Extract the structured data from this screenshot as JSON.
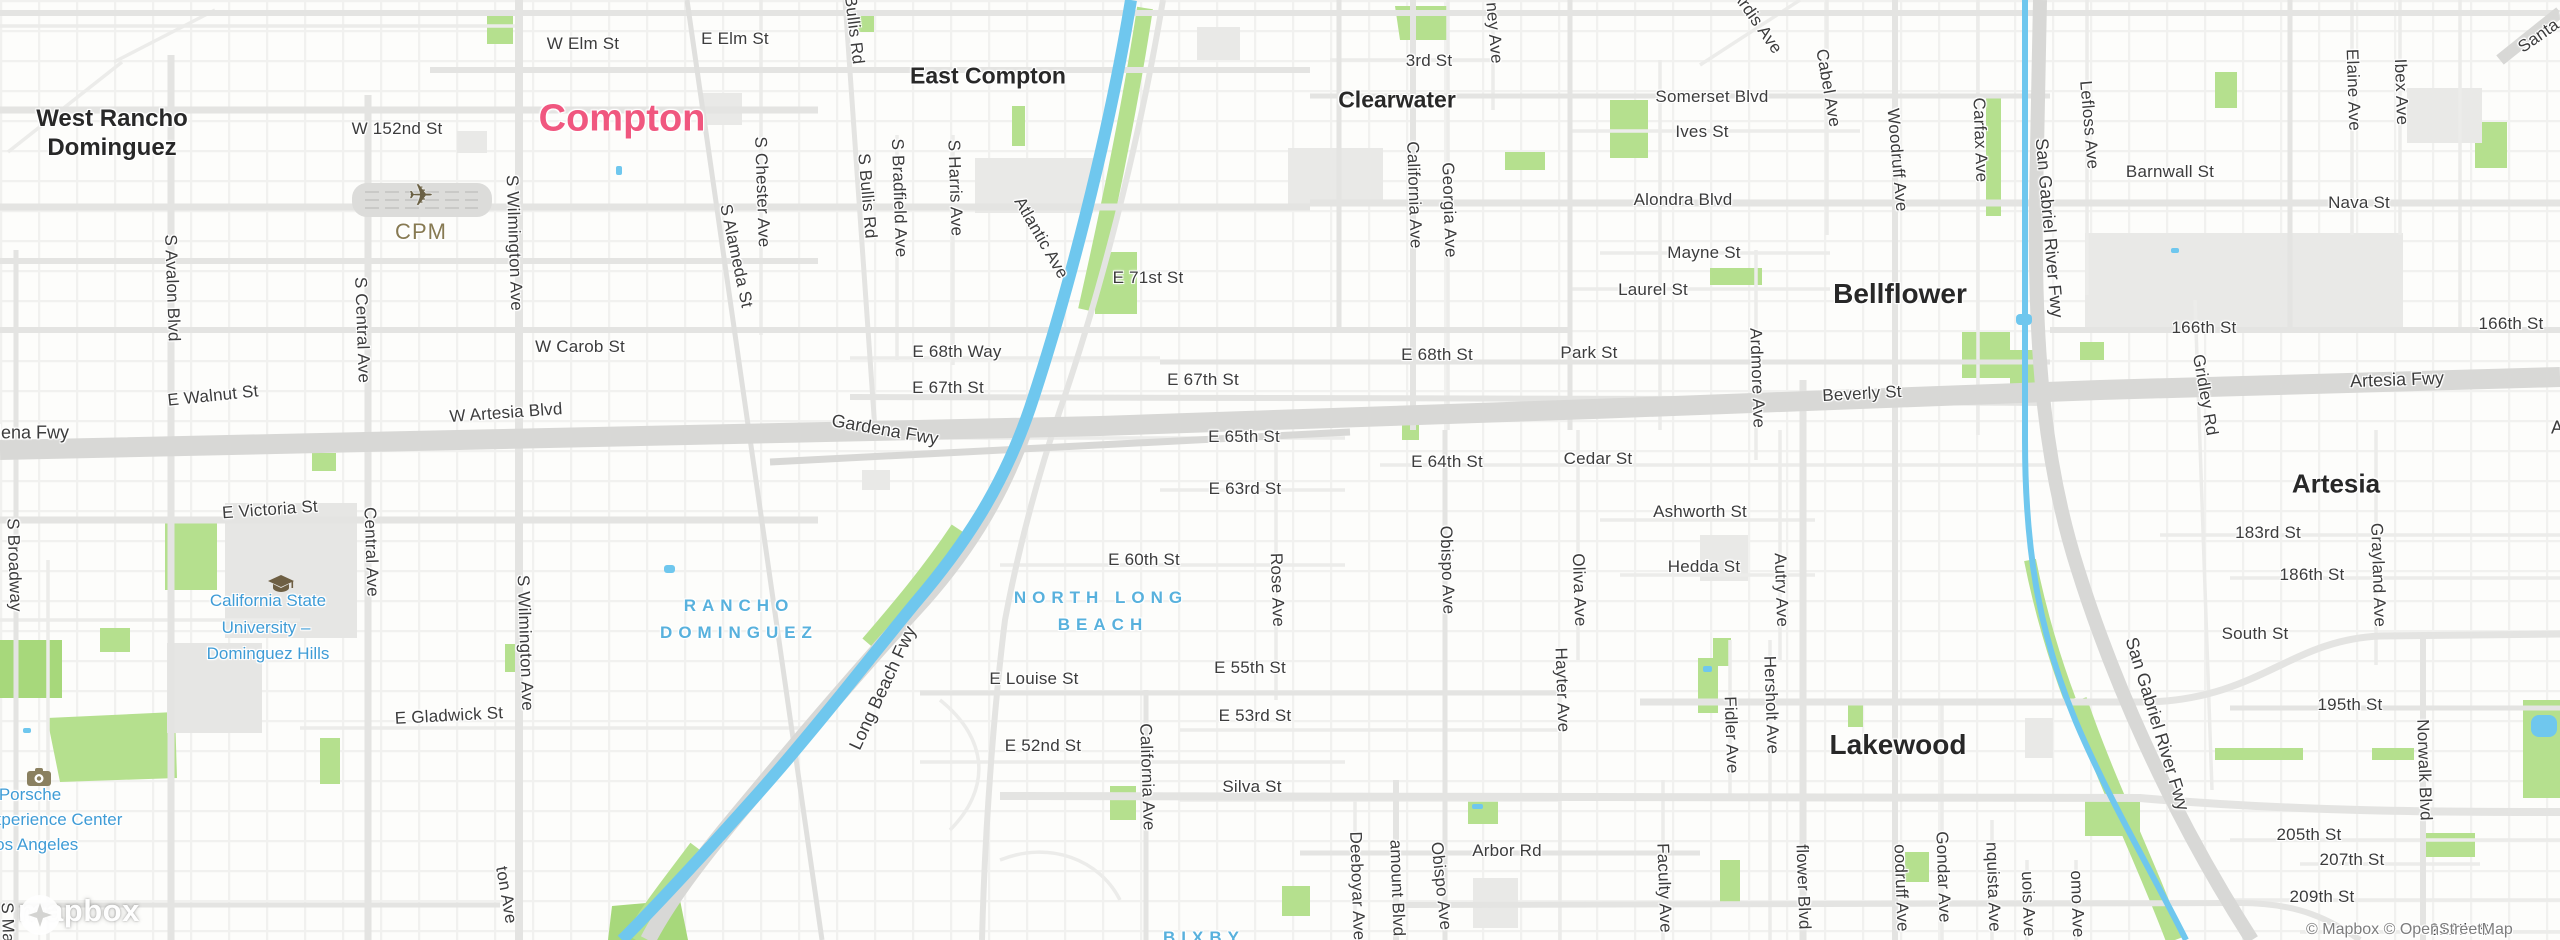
{
  "map": {
    "attribution": "© Mapbox © OpenStreetMap",
    "logo_text": "mapbox",
    "colors": {
      "city": "#f0577f",
      "town": "#282828",
      "district": "#58b1dd",
      "poi": "#3f9cd6",
      "street": "#3c3c3c",
      "airport": "#877a52",
      "water": "#6fc7ee",
      "park": "#b5e08e",
      "park_dark": "#a7d87b",
      "road": "#e4e4e2",
      "road_minor": "#ececea",
      "freeway": "#d8d8d6",
      "building": "#e9e9e7"
    },
    "labels": {
      "cities": [
        {
          "t": "Compton",
          "x": 622,
          "y": 119
        }
      ],
      "towns": [
        {
          "t": "West Rancho",
          "x": 112,
          "y": 119,
          "s": 24
        },
        {
          "t": "Dominguez",
          "x": 112,
          "y": 148,
          "s": 24
        },
        {
          "t": "East Compton",
          "x": 988,
          "y": 76,
          "s": 23
        },
        {
          "t": "Clearwater",
          "x": 1397,
          "y": 100,
          "s": 23
        },
        {
          "t": "Bellflower",
          "x": 1900,
          "y": 294,
          "s": 28
        },
        {
          "t": "Artesia",
          "x": 2336,
          "y": 484,
          "s": 26
        },
        {
          "t": "Lakewood",
          "x": 1898,
          "y": 745,
          "s": 28
        }
      ],
      "districts": [
        {
          "t": "NORTH LONG",
          "x": 1101,
          "y": 598
        },
        {
          "t": "BEACH",
          "x": 1103,
          "y": 625
        },
        {
          "t": "RANCHO",
          "x": 739,
          "y": 606
        },
        {
          "t": "DOMINGUEZ",
          "x": 739,
          "y": 633
        },
        {
          "t": "BIXBY",
          "x": 1204,
          "y": 938
        }
      ],
      "pois": [
        {
          "t": "California State",
          "x": 268,
          "y": 601
        },
        {
          "t": "University –",
          "x": 266,
          "y": 628
        },
        {
          "t": "Dominguez Hills",
          "x": 268,
          "y": 654
        },
        {
          "t": "Porsche",
          "x": 30,
          "y": 795
        },
        {
          "t": "Experience Center",
          "x": 52,
          "y": 820
        },
        {
          "t": "Los Angeles",
          "x": 32,
          "y": 845
        }
      ],
      "airport": {
        "t": "CPM",
        "x": 421,
        "y": 232
      },
      "streets": [
        {
          "t": "W Elm St",
          "x": 583,
          "y": 44
        },
        {
          "t": "E Elm St",
          "x": 735,
          "y": 39
        },
        {
          "t": "Bullis Rd",
          "x": 854,
          "y": 30,
          "r": 83
        },
        {
          "t": "W 152nd St",
          "x": 397,
          "y": 129
        },
        {
          "t": "S Avalon Blvd",
          "x": 172,
          "y": 288,
          "r": 88
        },
        {
          "t": "S Central Ave",
          "x": 362,
          "y": 330,
          "r": 88
        },
        {
          "t": "Central Ave",
          "x": 371,
          "y": 552,
          "r": 88
        },
        {
          "t": "S Wilmington Ave",
          "x": 514,
          "y": 243,
          "r": 88
        },
        {
          "t": "S Wilmington Ave",
          "x": 525,
          "y": 643,
          "r": 88
        },
        {
          "t": "ton Ave",
          "x": 506,
          "y": 895,
          "r": 80
        },
        {
          "t": "S Broadway",
          "x": 14,
          "y": 565,
          "r": 88
        },
        {
          "t": "S Main St",
          "x": 8,
          "y": 940,
          "r": 88
        },
        {
          "t": "S Bullis Rd",
          "x": 867,
          "y": 196,
          "r": 85
        },
        {
          "t": "S Bradfield Ave",
          "x": 899,
          "y": 198,
          "r": 88
        },
        {
          "t": "S Harris Ave",
          "x": 955,
          "y": 188,
          "r": 88
        },
        {
          "t": "S Chester Ave",
          "x": 762,
          "y": 192,
          "r": 88
        },
        {
          "t": "S Alameda St",
          "x": 736,
          "y": 256,
          "r": 78
        },
        {
          "t": "Atlantic Ave",
          "x": 1041,
          "y": 238,
          "r": 60
        },
        {
          "t": "E 71st St",
          "x": 1148,
          "y": 278
        },
        {
          "t": "E 68th Way",
          "x": 957,
          "y": 352
        },
        {
          "t": "E 67th St",
          "x": 948,
          "y": 388
        },
        {
          "t": "E 67th St",
          "x": 1203,
          "y": 380
        },
        {
          "t": "W Carob St",
          "x": 580,
          "y": 347
        },
        {
          "t": "E Walnut St",
          "x": 213,
          "y": 396,
          "r": -6
        },
        {
          "t": "W Artesia Blvd",
          "x": 506,
          "y": 413,
          "r": -4
        },
        {
          "t": "E 68th St",
          "x": 1437,
          "y": 355
        },
        {
          "t": "Park St",
          "x": 1589,
          "y": 353
        },
        {
          "t": "Beverly St",
          "x": 1862,
          "y": 394,
          "r": -3
        },
        {
          "t": "E 65th St",
          "x": 1244,
          "y": 437
        },
        {
          "t": "E 64th St",
          "x": 1447,
          "y": 462
        },
        {
          "t": "Cedar St",
          "x": 1598,
          "y": 459
        },
        {
          "t": "E 63rd St",
          "x": 1245,
          "y": 489
        },
        {
          "t": "Obispo Ave",
          "x": 1447,
          "y": 570,
          "r": 88
        },
        {
          "t": "Oliva Ave",
          "x": 1579,
          "y": 590,
          "r": 88
        },
        {
          "t": "Ashworth St",
          "x": 1700,
          "y": 512
        },
        {
          "t": "Hedda St",
          "x": 1704,
          "y": 567
        },
        {
          "t": "Autry Ave",
          "x": 1781,
          "y": 590,
          "r": 88
        },
        {
          "t": "Rose Ave",
          "x": 1277,
          "y": 590,
          "r": 88
        },
        {
          "t": "E 60th St",
          "x": 1144,
          "y": 560
        },
        {
          "t": "E Louise St",
          "x": 1034,
          "y": 679
        },
        {
          "t": "E 55th St",
          "x": 1250,
          "y": 668
        },
        {
          "t": "E 53rd St",
          "x": 1255,
          "y": 716
        },
        {
          "t": "E 52nd St",
          "x": 1043,
          "y": 746
        },
        {
          "t": "California Ave",
          "x": 1147,
          "y": 777,
          "r": 88
        },
        {
          "t": "Silva St",
          "x": 1252,
          "y": 787
        },
        {
          "t": "Hayter Ave",
          "x": 1562,
          "y": 690,
          "r": 88
        },
        {
          "t": "Fidler Ave",
          "x": 1731,
          "y": 735,
          "r": 88
        },
        {
          "t": "Hersholt Ave",
          "x": 1771,
          "y": 705,
          "r": 88
        },
        {
          "t": "Faculty Ave",
          "x": 1664,
          "y": 888,
          "r": 88
        },
        {
          "t": "flower Blvd",
          "x": 1803,
          "y": 887,
          "r": 88
        },
        {
          "t": "oodruff Ave",
          "x": 1901,
          "y": 888,
          "r": 88
        },
        {
          "t": "Gondar Ave",
          "x": 1943,
          "y": 877,
          "r": 88
        },
        {
          "t": "nquista Ave",
          "x": 1993,
          "y": 887,
          "r": 88
        },
        {
          "t": "uois Ave",
          "x": 2028,
          "y": 904,
          "r": 88
        },
        {
          "t": "omo Ave",
          "x": 2077,
          "y": 904,
          "r": 88
        },
        {
          "t": "Arbor Rd",
          "x": 1507,
          "y": 851
        },
        {
          "t": "Deeboyar Ave",
          "x": 1357,
          "y": 886,
          "r": 88
        },
        {
          "t": "amount Blvd",
          "x": 1397,
          "y": 888,
          "r": 88
        },
        {
          "t": "Obispo Ave",
          "x": 1441,
          "y": 886,
          "r": 84
        },
        {
          "t": "E Victoria St",
          "x": 270,
          "y": 510,
          "r": -4
        },
        {
          "t": "E Gladwick St",
          "x": 449,
          "y": 716,
          "r": -3
        },
        {
          "t": "Somerset Blvd",
          "x": 1712,
          "y": 97
        },
        {
          "t": "Ives St",
          "x": 1702,
          "y": 132
        },
        {
          "t": "3rd St",
          "x": 1429,
          "y": 61
        },
        {
          "t": "ney Ave",
          "x": 1494,
          "y": 33,
          "r": 85
        },
        {
          "t": "California Ave",
          "x": 1414,
          "y": 195,
          "r": 88
        },
        {
          "t": "Georgia Ave",
          "x": 1449,
          "y": 210,
          "r": 88
        },
        {
          "t": "Alondra Blvd",
          "x": 1683,
          "y": 200
        },
        {
          "t": "Mayne St",
          "x": 1704,
          "y": 253
        },
        {
          "t": "Laurel St",
          "x": 1653,
          "y": 290
        },
        {
          "t": "Ardis Ave",
          "x": 1757,
          "y": 22,
          "r": 55
        },
        {
          "t": "Cabel Ave",
          "x": 1828,
          "y": 88,
          "r": 80
        },
        {
          "t": "Woodruff Ave",
          "x": 1897,
          "y": 160,
          "r": 85
        },
        {
          "t": "Carfax Ave",
          "x": 1980,
          "y": 140,
          "r": 88
        },
        {
          "t": "Lefloss Ave",
          "x": 2089,
          "y": 125,
          "r": 85
        },
        {
          "t": "Barnwall St",
          "x": 2170,
          "y": 172
        },
        {
          "t": "Ardmore Ave",
          "x": 1757,
          "y": 378,
          "r": 88
        },
        {
          "t": "166th St",
          "x": 2204,
          "y": 328
        },
        {
          "t": "166th St",
          "x": 2511,
          "y": 324
        },
        {
          "t": "Gridley Rd",
          "x": 2205,
          "y": 395,
          "r": 80
        },
        {
          "t": "Elaine Ave",
          "x": 2353,
          "y": 90,
          "r": 88
        },
        {
          "t": "Ibex Ave",
          "x": 2401,
          "y": 92,
          "r": 88
        },
        {
          "t": "Nava St",
          "x": 2359,
          "y": 203
        },
        {
          "t": "Santa Ana",
          "x": 2553,
          "y": 26,
          "r": -35
        },
        {
          "t": "183rd St",
          "x": 2268,
          "y": 533
        },
        {
          "t": "186th St",
          "x": 2312,
          "y": 575
        },
        {
          "t": "Grayland Ave",
          "x": 2378,
          "y": 575,
          "r": 88
        },
        {
          "t": "South St",
          "x": 2255,
          "y": 634
        },
        {
          "t": "195th St",
          "x": 2350,
          "y": 705
        },
        {
          "t": "Norwalk Blvd",
          "x": 2424,
          "y": 770,
          "r": 88
        },
        {
          "t": "205th St",
          "x": 2309,
          "y": 835
        },
        {
          "t": "207th St",
          "x": 2352,
          "y": 860
        },
        {
          "t": "209th St",
          "x": 2322,
          "y": 897
        },
        {
          "t": "212th St",
          "x": 2462,
          "y": 930
        }
      ],
      "freeways": [
        {
          "t": "Gardena Fwy",
          "x": 15,
          "y": 433
        },
        {
          "t": "Gardena Fwy",
          "x": 885,
          "y": 430,
          "r": 10
        },
        {
          "t": "Long Beach Fwy",
          "x": 883,
          "y": 688,
          "r": -65
        },
        {
          "t": "San Gabriel River Fwy",
          "x": 2049,
          "y": 228,
          "r": 85
        },
        {
          "t": "San Gabriel River Fwy",
          "x": 2157,
          "y": 724,
          "r": 73
        },
        {
          "t": "Artesia Fwy",
          "x": 2397,
          "y": 380,
          "r": -2
        },
        {
          "t": "Artesia Fwy",
          "x": 2598,
          "y": 428
        }
      ]
    }
  }
}
